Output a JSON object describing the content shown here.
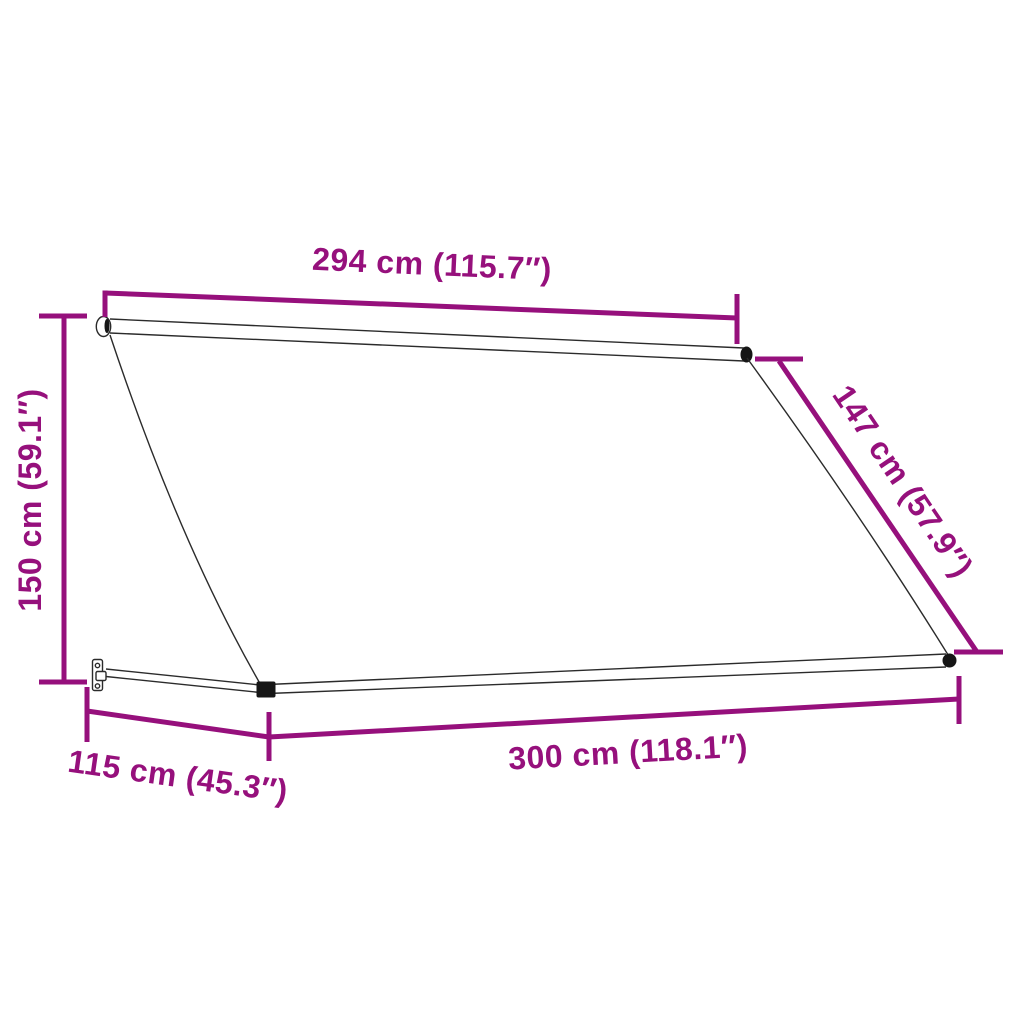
{
  "diagram": {
    "type": "product-dimension-diagram",
    "subject": "retractable drop-arm awning line drawing with dimension callouts",
    "colors": {
      "dimension_accent": "#96107C",
      "line_art": "#2b2b2b",
      "background": "#ffffff"
    },
    "dimensions": {
      "fabric_width": {
        "label": "294 cm (115.7″)",
        "cm": 294,
        "inches": 115.7,
        "position": "top"
      },
      "frame_height": {
        "label": "150 cm (59.1″)",
        "cm": 150,
        "inches": 59.1,
        "position": "left"
      },
      "fabric_drop": {
        "label": "147 cm (57.9″)",
        "cm": 147,
        "inches": 57.9,
        "position": "right-diagonal"
      },
      "projection": {
        "label": "115 cm (45.3″)",
        "cm": 115,
        "inches": 45.3,
        "position": "bottom-left"
      },
      "total_width": {
        "label": "300 cm (118.1″)",
        "cm": 300,
        "inches": 118.1,
        "position": "bottom"
      }
    }
  }
}
